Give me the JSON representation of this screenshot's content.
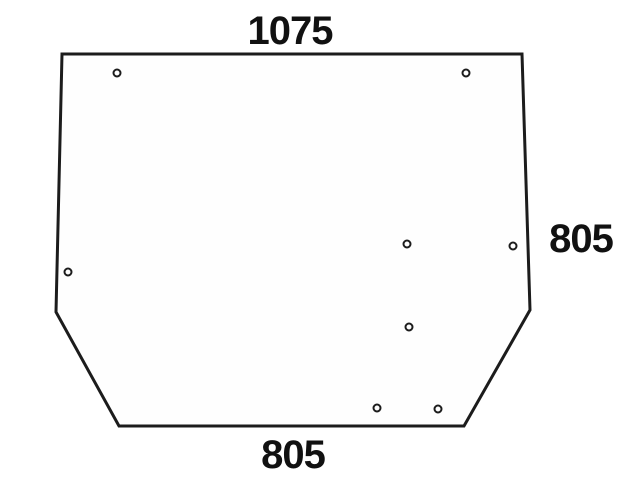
{
  "page": {
    "background_color": "#ffffff"
  },
  "diagram": {
    "type": "technical-drawing",
    "subject": "glass-panel-with-mounting-holes",
    "canvas": {
      "width": 617,
      "height": 480
    },
    "fill_color": "#fefefe",
    "stroke_color": "#1c1c1c",
    "stroke_width": 3,
    "hole_radius": 3.5,
    "hole_stroke_width": 2,
    "text_color": "#111111",
    "outline_points": [
      [
        62,
        54
      ],
      [
        522,
        54
      ],
      [
        530,
        310
      ],
      [
        464,
        426
      ],
      [
        119,
        426
      ],
      [
        56,
        312
      ]
    ],
    "holes": [
      {
        "x": 117,
        "y": 73
      },
      {
        "x": 466,
        "y": 73
      },
      {
        "x": 68,
        "y": 272
      },
      {
        "x": 407,
        "y": 244
      },
      {
        "x": 513,
        "y": 246
      },
      {
        "x": 409,
        "y": 327
      },
      {
        "x": 377,
        "y": 408
      },
      {
        "x": 438,
        "y": 409
      }
    ],
    "dimensions": {
      "top_width": {
        "value": "1075",
        "x": 290,
        "y": 44
      },
      "right_height": {
        "value": "805",
        "x": 581,
        "y": 252
      },
      "bottom_width": {
        "value": "805",
        "x": 293,
        "y": 468
      }
    }
  }
}
